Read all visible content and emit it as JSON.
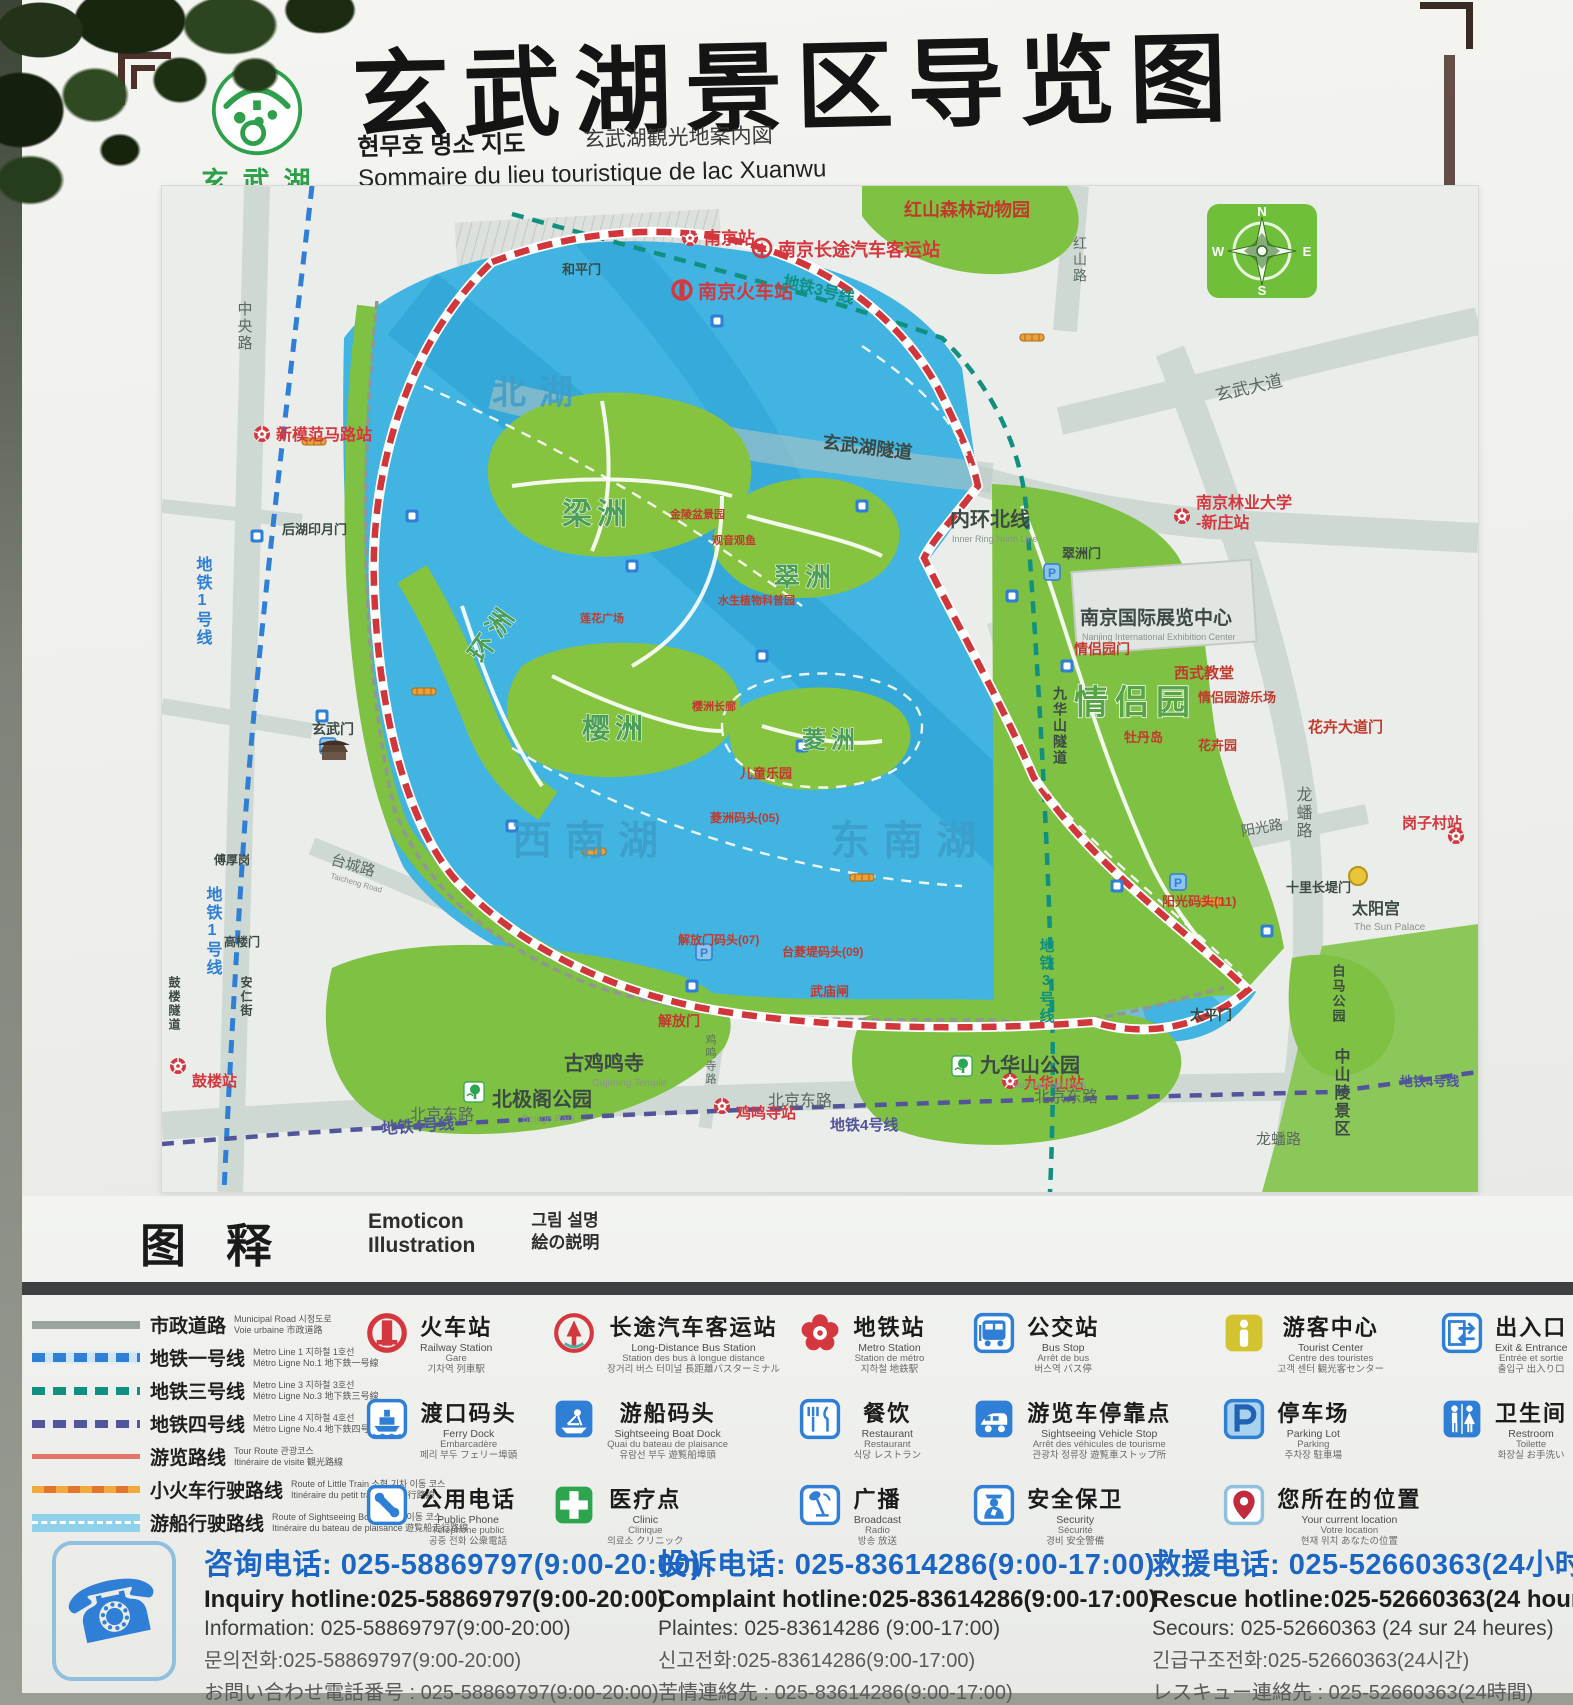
{
  "header": {
    "title": "玄武湖景区导览图",
    "logo": {
      "zh": "玄武湖",
      "en": "XUAN WU LAKE"
    },
    "sub_ko": "현무호 명소 지도",
    "sub_ja": "玄武湖観光地案内図",
    "sub_fr": "Sommaire du lieu touristique de lac Xuanwu",
    "sub_en": "Guide map of Xuanwu Lake Scenic Area"
  },
  "map": {
    "compass": {
      "n": "N",
      "e": "E",
      "s": "S",
      "w": "W"
    },
    "labels": {
      "north_lake": "北湖",
      "southwest_lake": "西南湖",
      "southeast_lake": "东南湖",
      "liangzhou": "梁洲",
      "cuizhou": "翠洲",
      "yingzhou": "樱洲",
      "huanzhou": "环洲",
      "lingzhou": "菱洲",
      "st_nanjing": "南京站",
      "st_nanjing_rail": "南京火车站",
      "st_bus_terminal": "南京长途汽车客运站",
      "st_xinmofan": "新模范马路站",
      "st_gulou": "鼓楼站",
      "st_jimingsi": "鸡鸣寺站",
      "st_jiuhuashan": "九华山站",
      "st_gangzicun": "岗子村站",
      "st_forestry1": "南京林业大学",
      "st_forestry2": "-新庄站",
      "rd_zhongyang": "中央路",
      "rd_hongshan": "红山路",
      "rd_xuanwu_ave": "玄武大道",
      "rd_longpan": "龙蟠路",
      "rd_longpan2": "龙蟠路",
      "rd_beijing1": "北京东路",
      "rd_beijing2": "北京东路",
      "rd_beijing3": "北京东路",
      "rd_taicheng": "台城路",
      "rd_taicheng_en": "Taicheng Road",
      "rd_yangguang": "阳光路",
      "rd_jimingsi": "鸡鸣寺路",
      "metro1a": "地铁1号线",
      "metro1b": "地铁1号线",
      "metro3a": "地铁3号线",
      "metro3b": "地铁3号线",
      "metro4a": "地铁4号线",
      "metro4b": "地铁4号线",
      "metro4c": "地铁4号线",
      "inner_ring": "内环北线",
      "inner_ring_en": "Inner Ring North Line",
      "xuanwu_tunnel": "玄武湖隧道",
      "jiuhua_tunnel": "九华山隧道",
      "gulou_tunnel": "鼓楼隧道",
      "zoo": "红山森林动物园",
      "exhibition": "南京国际展览中心",
      "exhibition_en": "Nanjing International Exhibition Center",
      "qinglv": "情侣园",
      "qinglv_gate": "情侣园门",
      "cuizhou_gate": "翠洲门",
      "church": "西式教堂",
      "playground": "情侣园游乐场",
      "peony": "牡丹岛",
      "flower_garden": "花卉园",
      "flower_gate": "花卉大道门",
      "sun_palace": "太阳宫",
      "sun_palace_en": "The Sun Palace",
      "shilichangdi": "十里长堤门",
      "yangguang_dock": "阳光码头(11)",
      "gujiming": "古鸡鸣寺",
      "gujiming_en": "Gujiming Temple",
      "beijige": "北极阁公园",
      "beijige_en": "Beijige Park",
      "jiuhua_park": "九华山公园",
      "jiuhua_park_en": "Jiuhuashan Park",
      "baima": "白马公园",
      "zhongshan": "中山陵景区",
      "xuanwumen": "玄武门",
      "jiefangmen": "解放门",
      "taipingmen": "太平门",
      "hepingmen": "和平门",
      "houhu_gate": "后湖印月门",
      "wumiaozha": "武庙闸",
      "children": "儿童乐园",
      "jiefang_dock": "解放门码头(07)",
      "tailing_dock": "台菱堤码头(09)",
      "lingzhou_dock": "菱洲码头(05)",
      "bonsai": "金陵盆景园",
      "guanyin": "观音观鱼",
      "aquatic": "水生植物科普园",
      "lotus_sq": "莲花广场",
      "yingzhou_corridor": "樱洲长廊",
      "fuhougang": "傅厚岗",
      "gaoloumen": "高楼门",
      "anrenjie": "安仁街",
      "p": "P"
    }
  },
  "legend": {
    "header": {
      "zh": "图释",
      "en1": "Emoticon",
      "en2": "Illustration",
      "ko": "그림 설명",
      "ja": "絵の説明"
    },
    "lines": [
      {
        "zh": "市政道路",
        "s1": "Municipal Road  시정도로",
        "s2": "Voie urbaine  市政道路",
        "style": "municipal"
      },
      {
        "zh": "地铁一号线",
        "s1": "Metro Line 1  지하철 1호선",
        "s2": "Métro Ligne No.1  地下鉄一号線",
        "style": "metro1"
      },
      {
        "zh": "地铁三号线",
        "s1": "Metro Line 3  지하철 3호선",
        "s2": "Métro Ligne No.3  地下鉄三号線",
        "style": "metro3"
      },
      {
        "zh": "地铁四号线",
        "s1": "Metro Line 4  지하철 4호선",
        "s2": "Métro Ligne No.4  地下鉄四号線",
        "style": "metro4"
      },
      {
        "zh": "游览路线",
        "s1": "Tour Route  관광코스",
        "s2": "Itinéraire de visite  観光路線",
        "style": "tour"
      },
      {
        "zh": "小火车行驶路线",
        "s1": "Route of Little Train  소형 기차 이동 코스",
        "s2": "Itinéraire du petit train  列車走行路線",
        "style": "train"
      },
      {
        "zh": "游船行驶路线",
        "s1": "Route of Sightseeing Boat  유람선 이동 코스",
        "s2": "Itinéraire du bateau de plaisance  遊覧船走行路線",
        "style": "boat"
      }
    ],
    "columns": [
      [
        {
          "zh": "火车站",
          "s1": "Railway Station",
          "s2": "Gare",
          "s3": "기차역  列車駅",
          "icon": "railway-station"
        },
        {
          "zh": "渡口码头",
          "s1": "Ferry Dock",
          "s2": "Embarcadère",
          "s3": "페리 부두  フェリー埠頭",
          "icon": "ferry-dock"
        },
        {
          "zh": "公用电话",
          "s1": "Public Phone",
          "s2": "Téléphone public",
          "s3": "공중 전화  公衆電話",
          "icon": "public-phone"
        }
      ],
      [
        {
          "zh": "长途汽车客运站",
          "s1": "Long-Distance Bus Station",
          "s2": "Station des bus à longue distance",
          "s3": "장거리 버스 터미널  長距離バスターミナル",
          "icon": "long-distance-bus"
        },
        {
          "zh": "游船码头",
          "s1": "Sightseeing Boat Dock",
          "s2": "Quai du bateau de plaisance",
          "s3": "유람선 부두  遊覧船埠頭",
          "icon": "boat-dock"
        },
        {
          "zh": "医疗点",
          "s1": "Clinic",
          "s2": "Clinique",
          "s3": "의료소  クリニック",
          "icon": "clinic"
        }
      ],
      [
        {
          "zh": "地铁站",
          "s1": "Metro Station",
          "s2": "Station de métro",
          "s3": "지하철  地鉄駅",
          "icon": "metro-station"
        },
        {
          "zh": "餐饮",
          "s1": "Restaurant",
          "s2": "Restaurant",
          "s3": "식당  レストラン",
          "icon": "restaurant"
        },
        {
          "zh": "广播",
          "s1": "Broadcast",
          "s2": "Radio",
          "s3": "방송  放送",
          "icon": "broadcast"
        }
      ],
      [
        {
          "zh": "公交站",
          "s1": "Bus Stop",
          "s2": "Arrêt de bus",
          "s3": "버스역  バス停",
          "icon": "bus-stop"
        },
        {
          "zh": "游览车停靠点",
          "s1": "Sightseeing Vehicle Stop",
          "s2": "Arrêt des véhicules de tourisme",
          "s3": "관광차 정류장  遊覧車ストップ所",
          "icon": "sightseeing-vehicle"
        },
        {
          "zh": "安全保卫",
          "s1": "Security",
          "s2": "Sécurité",
          "s3": "경비  安全警備",
          "icon": "security"
        }
      ],
      [
        {
          "zh": "游客中心",
          "s1": "Tourist Center",
          "s2": "Centre des touristes",
          "s3": "고객 센터  観光客センター",
          "icon": "tourist-center"
        },
        {
          "zh": "停车场",
          "s1": "Parking Lot",
          "s2": "Parking",
          "s3": "주차장  駐車場",
          "icon": "parking"
        },
        {
          "zh": "您所在的位置",
          "s1": "Your current location",
          "s2": "Votre location",
          "s3": "현재 위치  あなたの位置",
          "icon": "current-location"
        }
      ],
      [
        {
          "zh": "出入口",
          "s1": "Exit & Entrance",
          "s2": "Entrée et sortie",
          "s3": "출입구  出入り口",
          "icon": "exit-entrance"
        },
        {
          "zh": "卫生间",
          "s1": "Restroom",
          "s2": "Toilette",
          "s3": "화장실  お手洗い",
          "icon": "restroom"
        }
      ]
    ]
  },
  "hotlines": [
    {
      "zh": "咨询电话: 025-58869797(9:00-20:00)",
      "en": "Inquiry hotline:025-58869797(9:00-20:00)",
      "l3": "Information: 025-58869797(9:00-20:00)",
      "ko": "문의전화:025-58869797(9:00-20:00)",
      "ja": "お問い合わせ電話番号 : 025-58869797(9:00-20:00)"
    },
    {
      "zh": "投诉电话: 025-83614286(9:00-17:00)",
      "en": "Complaint hotline:025-83614286(9:00-17:00)",
      "l3": "Plaintes: 025-83614286 (9:00-17:00)",
      "ko": "신고전화:025-83614286(9:00-17:00)",
      "ja": "苦情連絡先 : 025-83614286(9:00-17:00)"
    },
    {
      "zh": "救援电话: 025-52660363(24小时)",
      "en": "Rescue hotline:025-52660363(24 hours)",
      "l3": "Secours: 025-52660363 (24 sur 24 heures)",
      "ko": "긴급구조전화:025-52660363(24시간)",
      "ja": "レスキュー連絡先 : 025-52660363(24時間)"
    }
  ]
}
